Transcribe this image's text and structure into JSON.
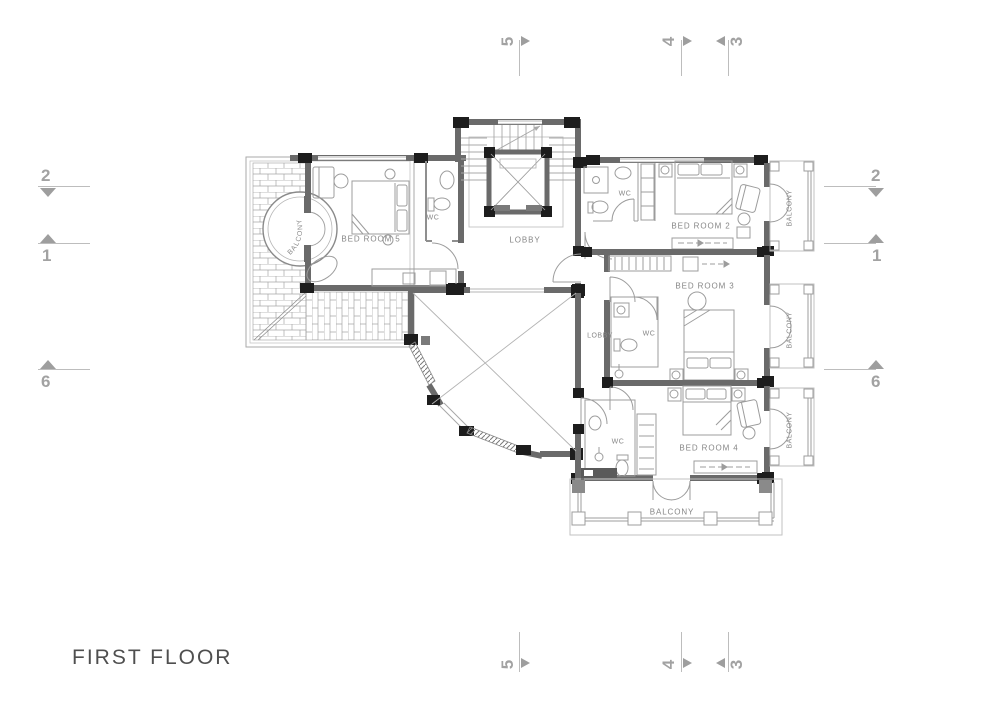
{
  "title": "FIRST FLOOR",
  "grid": {
    "top": [
      {
        "label": "5"
      },
      {
        "label": "4"
      },
      {
        "label": "3"
      }
    ],
    "bottom": [
      {
        "label": "5"
      },
      {
        "label": "4"
      },
      {
        "label": "3"
      }
    ],
    "left": [
      {
        "label": "2"
      },
      {
        "label": "1"
      },
      {
        "label": "6"
      }
    ],
    "right": [
      {
        "label": "2"
      },
      {
        "label": "1"
      },
      {
        "label": "6"
      }
    ]
  },
  "rooms": {
    "bedroom5": "BED ROOM 5",
    "bedroom2": "BED ROOM 2",
    "bedroom3": "BED ROOM 3",
    "bedroom4": "BED ROOM 4",
    "lobby_main": "LOBBY",
    "lobby_small": "LOBBY",
    "wc_bedroom5": "WC",
    "wc_bedroom2": "WC",
    "wc_bedroom3": "WC",
    "wc_bedroom4": "WC",
    "balcony_round": "BALCONY",
    "balcony_bedroom2": "BALCONY",
    "balcony_bedroom3": "BALCONY",
    "balcony_bedroom4": "BALCONY",
    "balcony_bottom": "BALCONY"
  },
  "colors": {
    "wall": "#6a6a6a",
    "column": "#1d1d1d",
    "thin_line": "#9c9c9c",
    "faint_line": "#c2c2c2",
    "marker": "#a2a2a2",
    "label_text": "#868686",
    "title_text": "#4f4f4f"
  }
}
